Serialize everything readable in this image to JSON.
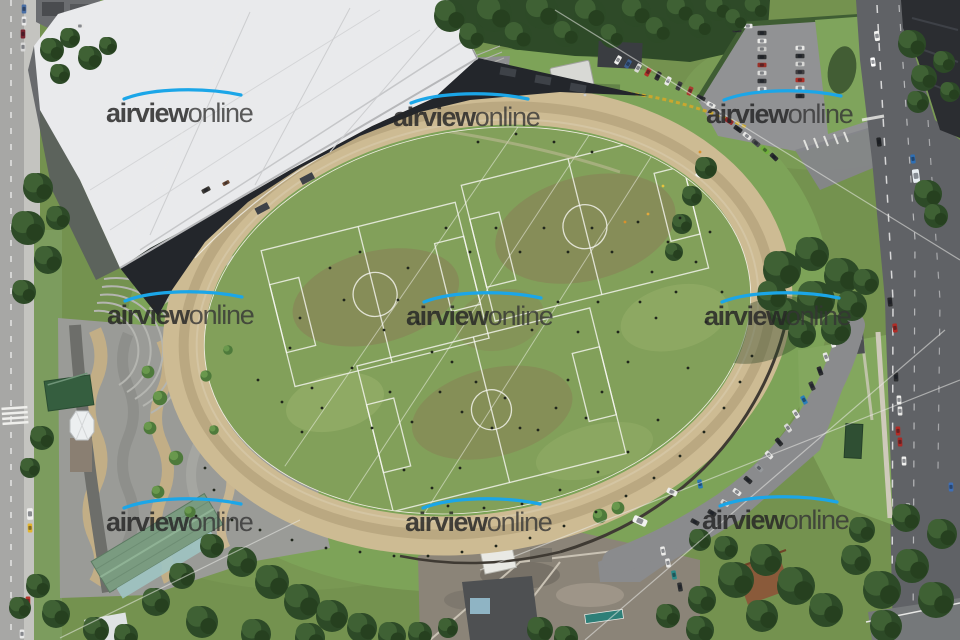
{
  "image": {
    "type": "aerial-photograph",
    "subject": "oval speedway track with grass soccer fields inside, grandstand building, plaza, parking lots, streets and trees"
  },
  "watermark": {
    "bold": "airview",
    "light": "online",
    "swoosh_color": "#1ba6e8",
    "text_color": "#333333",
    "instances": [
      {
        "x": 106,
        "y": 100
      },
      {
        "x": 393,
        "y": 104
      },
      {
        "x": 706,
        "y": 101
      },
      {
        "x": 107,
        "y": 302
      },
      {
        "x": 406,
        "y": 303
      },
      {
        "x": 704,
        "y": 303
      },
      {
        "x": 106,
        "y": 509
      },
      {
        "x": 405,
        "y": 509
      },
      {
        "x": 702,
        "y": 507
      }
    ]
  },
  "palette": {
    "track_tan": "#cdbb93",
    "infield_green": "#82a05a",
    "lawn_green": "#7da358",
    "tree_dark_green": "#2d4a27",
    "roof_white": "#e9eaec",
    "grandstand_dark": "#23262b",
    "plaza_gray": "#9a9b97",
    "plaza_wave_tan": "#c2ae86",
    "road_dark": "#606266",
    "road_light": "#a7a7a5",
    "shed_green": "#7a9b80",
    "rust_roof": "#8a5a3a"
  },
  "scene": {
    "people": [
      [
        300,
        318
      ],
      [
        290,
        348
      ],
      [
        312,
        388
      ],
      [
        330,
        268
      ],
      [
        344,
        300
      ],
      [
        360,
        252
      ],
      [
        352,
        368
      ],
      [
        322,
        408
      ],
      [
        372,
        428
      ],
      [
        384,
        330
      ],
      [
        398,
        300
      ],
      [
        408,
        268
      ],
      [
        418,
        322
      ],
      [
        432,
        352
      ],
      [
        390,
        392
      ],
      [
        412,
        422
      ],
      [
        440,
        392
      ],
      [
        452,
        362
      ],
      [
        462,
        412
      ],
      [
        476,
        382
      ],
      [
        492,
        428
      ],
      [
        505,
        398
      ],
      [
        520,
        428
      ],
      [
        538,
        430
      ],
      [
        556,
        408
      ],
      [
        568,
        380
      ],
      [
        586,
        418
      ],
      [
        602,
        392
      ],
      [
        628,
        362
      ],
      [
        618,
        332
      ],
      [
        640,
        302
      ],
      [
        652,
        272
      ],
      [
        668,
        242
      ],
      [
        680,
        218
      ],
      [
        638,
        222
      ],
      [
        612,
        252
      ],
      [
        592,
        228
      ],
      [
        568,
        252
      ],
      [
        544,
        228
      ],
      [
        520,
        252
      ],
      [
        496,
        228
      ],
      [
        470,
        252
      ],
      [
        446,
        228
      ],
      [
        558,
        302
      ],
      [
        578,
        332
      ],
      [
        532,
        330
      ],
      [
        598,
        302
      ],
      [
        656,
        318
      ],
      [
        676,
        292
      ],
      [
        696,
        262
      ],
      [
        710,
        232
      ],
      [
        722,
        292
      ],
      [
        706,
        322
      ],
      [
        478,
        142
      ],
      [
        516,
        134
      ],
      [
        554,
        142
      ],
      [
        592,
        152
      ],
      [
        460,
        468
      ],
      [
        432,
        488
      ],
      [
        404,
        470
      ],
      [
        302,
        432
      ],
      [
        282,
        402
      ],
      [
        258,
        380
      ],
      [
        688,
        368
      ],
      [
        658,
        420
      ],
      [
        628,
        452
      ],
      [
        598,
        472
      ],
      [
        560,
        490
      ],
      [
        522,
        504
      ],
      [
        484,
        508
      ],
      [
        448,
        506
      ],
      [
        205,
        468
      ],
      [
        214,
        490
      ],
      [
        196,
        516
      ],
      [
        232,
        520
      ],
      [
        260,
        530
      ],
      [
        292,
        540
      ],
      [
        326,
        548
      ],
      [
        360,
        552
      ],
      [
        394,
        556
      ],
      [
        428,
        556
      ],
      [
        462,
        552
      ],
      [
        496,
        546
      ],
      [
        530,
        538
      ],
      [
        564,
        526
      ],
      [
        596,
        512
      ],
      [
        626,
        496
      ],
      [
        654,
        478
      ],
      [
        680,
        456
      ],
      [
        704,
        432
      ],
      [
        724,
        408
      ],
      [
        740,
        382
      ],
      [
        752,
        356
      ],
      [
        625,
        222,
        "#d9902c"
      ],
      [
        648,
        214,
        "#e2a93c"
      ],
      [
        700,
        152,
        "#d9902c"
      ],
      [
        663,
        186,
        "#e5c33e"
      ],
      [
        585,
        95,
        "#cccccc"
      ]
    ],
    "cars": [
      [
        24,
        9,
        90,
        "#4a6fa5"
      ],
      [
        24,
        21,
        90,
        "#e8e8e8"
      ],
      [
        23,
        34,
        90,
        "#7a2430"
      ],
      [
        23,
        47,
        90,
        "#d8d8d8"
      ],
      [
        80,
        26,
        0,
        "#e8e8e8",
        0.9
      ],
      [
        28,
        601,
        90,
        "#b8352b"
      ],
      [
        30,
        514,
        88,
        "#efefed",
        1.3
      ],
      [
        30,
        528,
        88,
        "#e3b52c"
      ],
      [
        22,
        634,
        90,
        "#e8e8e8"
      ],
      [
        618,
        60,
        120,
        "#f2f2f0"
      ],
      [
        628,
        64,
        120,
        "#3d5f8f"
      ],
      [
        638,
        68,
        118,
        "#d9d9d7"
      ],
      [
        648,
        72,
        118,
        "#b03028"
      ],
      [
        658,
        76,
        116,
        "#2e2e30"
      ],
      [
        668,
        81,
        116,
        "#ececea"
      ],
      [
        679,
        86,
        114,
        "#3a3a3c"
      ],
      [
        690,
        91,
        112,
        "#a83c30"
      ],
      [
        701,
        98,
        25,
        "#2e3032"
      ],
      [
        711,
        105,
        28,
        "#e9e9e7"
      ],
      [
        720,
        113,
        30,
        "#c8c8c6"
      ],
      [
        729,
        121,
        33,
        "#94282a"
      ],
      [
        738,
        129,
        35,
        "#28292b"
      ],
      [
        747,
        136,
        38,
        "#e6e6e4"
      ],
      [
        756,
        143,
        40,
        "#4a4c4e"
      ],
      [
        765,
        150,
        42,
        "#6fae3b"
      ],
      [
        774,
        157,
        44,
        "#2b2d2f"
      ],
      [
        762,
        33,
        0,
        "#303234"
      ],
      [
        762,
        41,
        0,
        "#e9e9e7"
      ],
      [
        762,
        49,
        0,
        "#c9c9c7"
      ],
      [
        762,
        57,
        0,
        "#2c2e30"
      ],
      [
        762,
        65,
        0,
        "#993028"
      ],
      [
        762,
        73,
        0,
        "#dcdcda"
      ],
      [
        762,
        81,
        0,
        "#35373a"
      ],
      [
        762,
        89,
        0,
        "#e4e4e2"
      ],
      [
        800,
        48,
        0,
        "#e8e8e6"
      ],
      [
        800,
        56,
        0,
        "#2f3133"
      ],
      [
        800,
        64,
        0,
        "#d7d7d5"
      ],
      [
        800,
        72,
        0,
        "#413f41"
      ],
      [
        800,
        80,
        0,
        "#ad2f27"
      ],
      [
        800,
        88,
        0,
        "#dfdfdd"
      ],
      [
        800,
        96,
        0,
        "#2c2e31"
      ],
      [
        737,
        30,
        0,
        "#2f3133"
      ],
      [
        748,
        26,
        0,
        "#e6e6e4"
      ],
      [
        877,
        36,
        83,
        "#f4f4f2",
        1.1
      ],
      [
        873,
        62,
        83,
        "#ffffff"
      ],
      [
        879,
        142,
        83,
        "#232527"
      ],
      [
        916,
        176,
        83,
        "#e8eef2",
        1.5
      ],
      [
        913,
        159,
        83,
        "#2f6fb4"
      ],
      [
        890,
        302,
        84,
        "#28292b"
      ],
      [
        895,
        328,
        84,
        "#b02c26"
      ],
      [
        896,
        377,
        88,
        "#2b2d2f"
      ],
      [
        899,
        400,
        88,
        "#ededeb"
      ],
      [
        900,
        411,
        88,
        "#e6e6e4"
      ],
      [
        898,
        431,
        88,
        "#b22c26"
      ],
      [
        900,
        442,
        88,
        "#a82a26"
      ],
      [
        904,
        461,
        88,
        "#efefed"
      ],
      [
        908,
        508,
        88,
        "#f1f1ef"
      ],
      [
        951,
        487,
        88,
        "#3f6fb5"
      ],
      [
        914,
        556,
        88,
        "#2d2f31"
      ],
      [
        833,
        343,
        75,
        "#ededeb"
      ],
      [
        826,
        357,
        72,
        "#e7e7e5"
      ],
      [
        820,
        371,
        70,
        "#2b2d2f"
      ],
      [
        812,
        386,
        66,
        "#35373a"
      ],
      [
        804,
        400,
        62,
        "#2b7fb8"
      ],
      [
        796,
        414,
        58,
        "#e9e9e7"
      ],
      [
        788,
        428,
        54,
        "#d8d8d6"
      ],
      [
        779,
        442,
        50,
        "#2c2e30"
      ],
      [
        769,
        455,
        46,
        "#e5e5e3"
      ],
      [
        759,
        468,
        43,
        "#96999c"
      ],
      [
        748,
        480,
        40,
        "#2d2f31"
      ],
      [
        737,
        492,
        36,
        "#e8e8e6"
      ],
      [
        725,
        503,
        33,
        "#d6d6d4"
      ],
      [
        712,
        513,
        30,
        "#2f3133"
      ],
      [
        640,
        521,
        24,
        "#f2f2f0",
        1.6
      ],
      [
        672,
        492,
        26,
        "#efefed",
        1.2
      ],
      [
        700,
        484,
        80,
        "#2879b8"
      ],
      [
        663,
        551,
        80,
        "#ececea"
      ],
      [
        668,
        563,
        80,
        "#e9e9e7"
      ],
      [
        674,
        575,
        80,
        "#2a8a88"
      ],
      [
        680,
        587,
        80,
        "#303234"
      ],
      [
        695,
        522,
        28,
        "#2f3133"
      ],
      [
        206,
        190,
        -28,
        "#3c3a36"
      ],
      [
        226,
        183,
        -28,
        "#6b4b36",
        0.8
      ],
      [
        700,
        172,
        -60,
        "#f4f4f2",
        1.2
      ]
    ],
    "trees": [
      [
        450,
        16,
        1.6
      ],
      [
        472,
        36,
        1.3
      ],
      [
        494,
        14,
        1.8
      ],
      [
        518,
        36,
        1.4
      ],
      [
        542,
        12,
        1.7
      ],
      [
        566,
        34,
        1.3
      ],
      [
        590,
        14,
        1.6
      ],
      [
        612,
        36,
        1.2
      ],
      [
        636,
        12,
        1.5
      ],
      [
        658,
        30,
        1.3
      ],
      [
        680,
        10,
        1.4
      ],
      [
        700,
        26,
        1.2
      ],
      [
        718,
        8,
        1.3
      ],
      [
        736,
        20,
        1.1
      ],
      [
        756,
        8,
        1.2
      ],
      [
        52,
        50,
        1.2
      ],
      [
        70,
        38,
        1.0
      ],
      [
        90,
        58,
        1.2
      ],
      [
        60,
        74,
        1.0
      ],
      [
        108,
        46,
        0.9
      ],
      [
        38,
        188,
        1.5
      ],
      [
        28,
        228,
        1.7
      ],
      [
        48,
        260,
        1.4
      ],
      [
        24,
        292,
        1.2
      ],
      [
        58,
        218,
        1.2
      ],
      [
        42,
        438,
        1.2
      ],
      [
        30,
        468,
        1.0
      ],
      [
        38,
        586,
        1.2
      ],
      [
        56,
        614,
        1.4
      ],
      [
        20,
        608,
        1.1
      ],
      [
        96,
        630,
        1.3
      ],
      [
        126,
        636,
        1.2
      ],
      [
        148,
        372,
        0.8,
        "l"
      ],
      [
        160,
        398,
        0.9,
        "l"
      ],
      [
        150,
        428,
        0.8,
        "l"
      ],
      [
        176,
        458,
        0.9,
        "l"
      ],
      [
        158,
        492,
        0.8,
        "l"
      ],
      [
        190,
        512,
        0.7,
        "l"
      ],
      [
        206,
        376,
        0.7,
        "l"
      ],
      [
        228,
        350,
        0.6,
        "l"
      ],
      [
        214,
        430,
        0.6,
        "l"
      ],
      [
        212,
        546,
        1.2
      ],
      [
        242,
        562,
        1.5
      ],
      [
        272,
        582,
        1.7
      ],
      [
        302,
        602,
        1.8
      ],
      [
        332,
        616,
        1.6
      ],
      [
        362,
        628,
        1.5
      ],
      [
        392,
        636,
        1.4
      ],
      [
        182,
        576,
        1.3
      ],
      [
        156,
        602,
        1.4
      ],
      [
        202,
        622,
        1.6
      ],
      [
        256,
        634,
        1.5
      ],
      [
        310,
        638,
        1.5
      ],
      [
        420,
        634,
        1.2
      ],
      [
        540,
        630,
        1.3
      ],
      [
        566,
        638,
        1.2
      ],
      [
        448,
        628,
        1.0
      ],
      [
        600,
        516,
        0.9,
        "l"
      ],
      [
        618,
        508,
        0.8,
        "l"
      ],
      [
        736,
        580,
        1.8
      ],
      [
        766,
        560,
        1.6
      ],
      [
        796,
        586,
        1.9
      ],
      [
        826,
        610,
        1.7
      ],
      [
        762,
        616,
        1.6
      ],
      [
        702,
        600,
        1.4
      ],
      [
        856,
        560,
        1.5
      ],
      [
        882,
        590,
        1.9
      ],
      [
        912,
        566,
        1.7
      ],
      [
        936,
        600,
        1.8
      ],
      [
        886,
        626,
        1.6
      ],
      [
        942,
        534,
        1.5
      ],
      [
        906,
        518,
        1.4
      ],
      [
        862,
        530,
        1.3
      ],
      [
        700,
        630,
        1.4
      ],
      [
        668,
        616,
        1.2
      ],
      [
        782,
        270,
        1.9
      ],
      [
        812,
        254,
        1.7
      ],
      [
        842,
        276,
        1.8
      ],
      [
        816,
        300,
        1.9
      ],
      [
        786,
        314,
        1.6
      ],
      [
        852,
        306,
        1.5
      ],
      [
        866,
        282,
        1.3
      ],
      [
        802,
        334,
        1.4
      ],
      [
        836,
        330,
        1.5
      ],
      [
        772,
        296,
        1.5
      ],
      [
        912,
        44,
        1.4
      ],
      [
        924,
        78,
        1.3
      ],
      [
        918,
        102,
        1.1
      ],
      [
        928,
        194,
        1.4
      ],
      [
        936,
        216,
        1.2
      ],
      [
        950,
        92,
        1.0
      ],
      [
        944,
        62,
        1.1
      ],
      [
        706,
        168,
        1.1
      ],
      [
        692,
        196,
        1.0
      ],
      [
        682,
        224,
        1.0
      ],
      [
        674,
        252,
        0.9
      ],
      [
        700,
        540,
        1.1
      ],
      [
        726,
        548,
        1.2
      ]
    ]
  }
}
